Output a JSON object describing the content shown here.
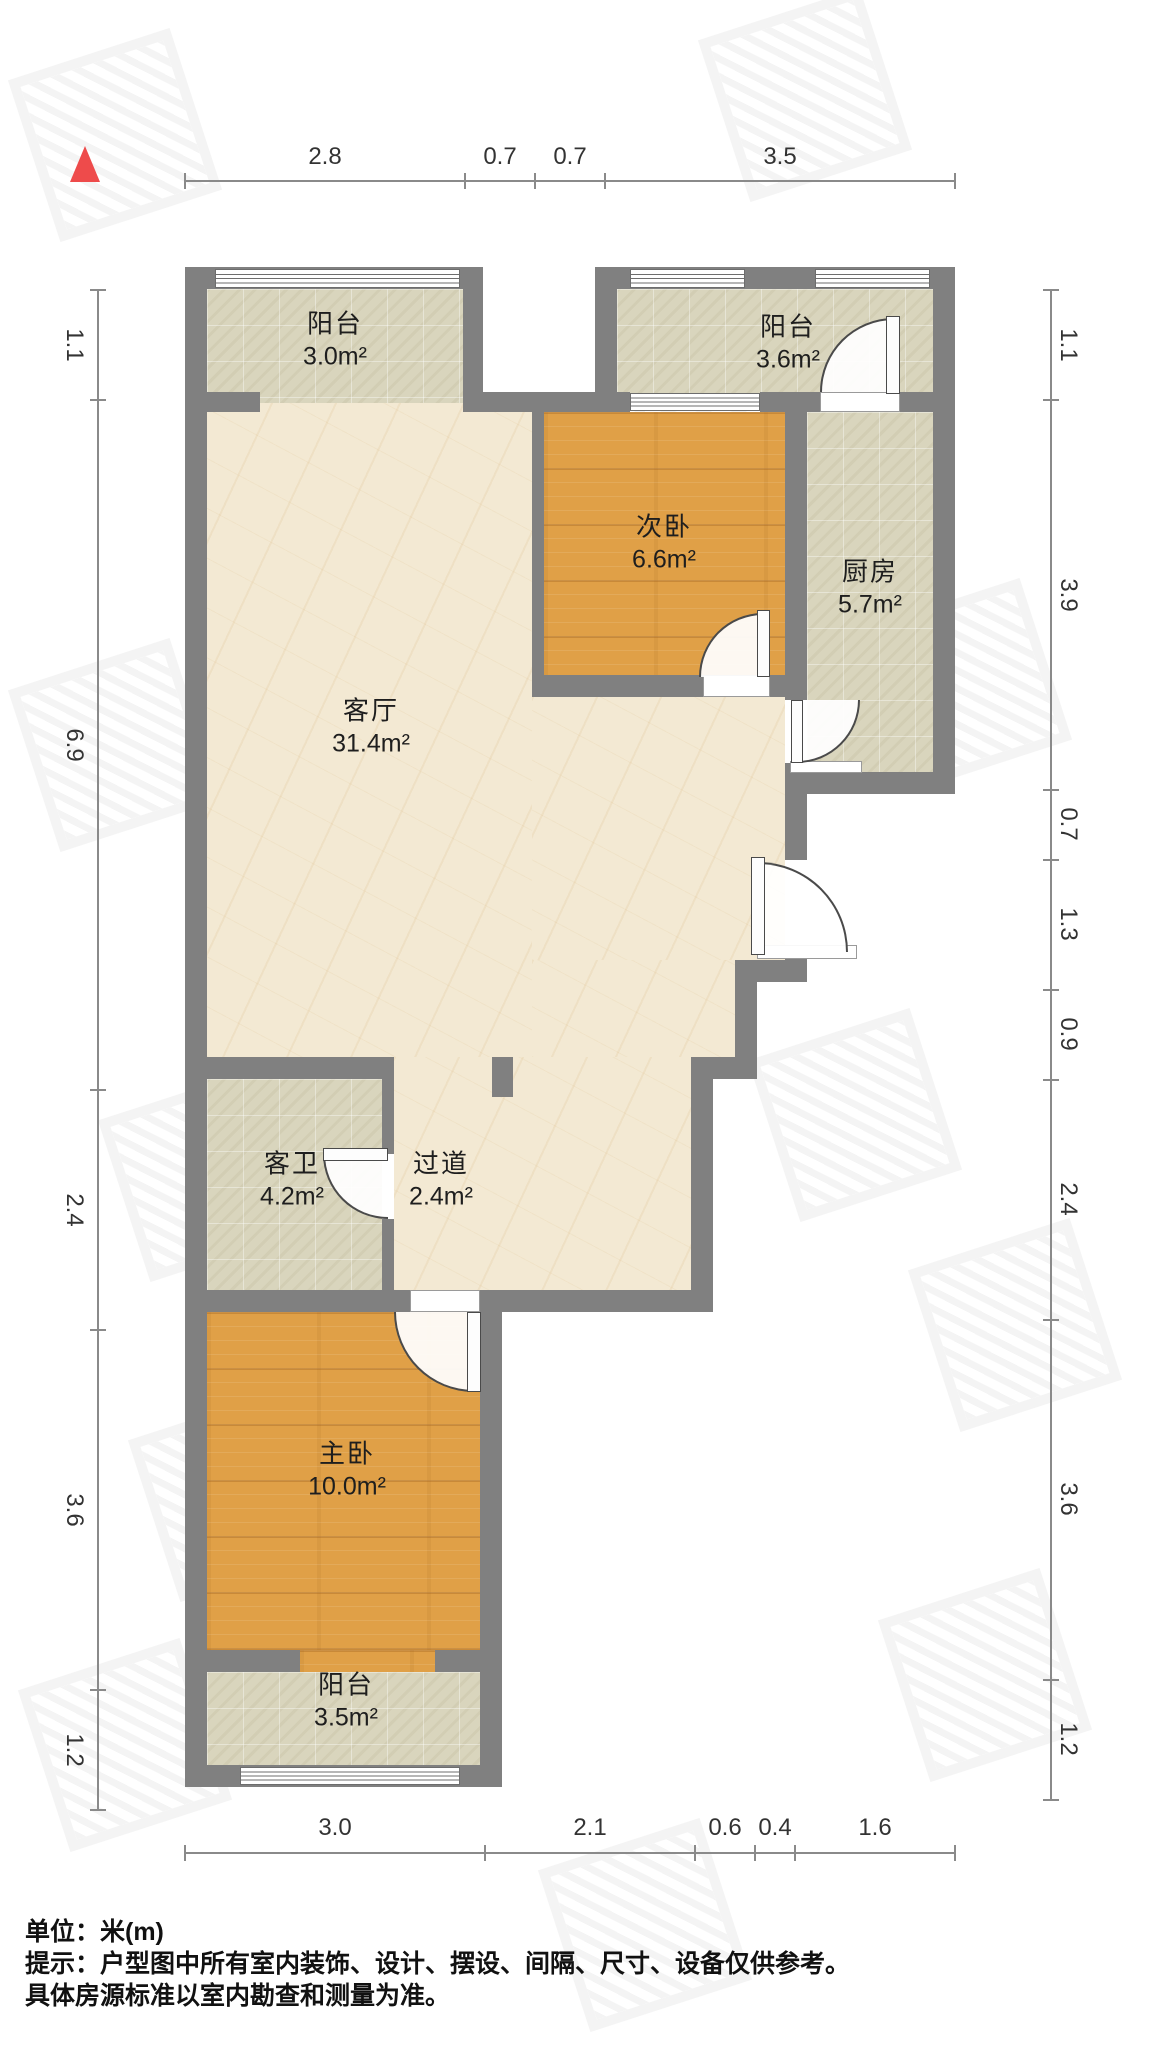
{
  "plan": {
    "type": "apartment-floorplan",
    "north_marker": "north-triangle",
    "colors": {
      "wall": "#808080",
      "wood_floor": "#e0a047",
      "tile_floor": "#d9d5bd",
      "marble_floor": "#f3e9d3",
      "north_red": "#ee4b4b",
      "dimension_line": "#8a8a8a",
      "text": "#1e1e1e"
    }
  },
  "rooms": [
    {
      "name": "阳台",
      "area": "3.0m²"
    },
    {
      "name": "阳台",
      "area": "3.6m²"
    },
    {
      "name": "次卧",
      "area": "6.6m²"
    },
    {
      "name": "厨房",
      "area": "5.7m²"
    },
    {
      "name": "客厅",
      "area": "31.4m²"
    },
    {
      "name": "客卫",
      "area": "4.2m²"
    },
    {
      "name": "过道",
      "area": "2.4m²"
    },
    {
      "name": "主卧",
      "area": "10.0m²"
    },
    {
      "name": "阳台",
      "area": "3.5m²"
    }
  ],
  "dimensions": {
    "top": [
      "2.8",
      "0.7",
      "0.7",
      "3.5"
    ],
    "left": [
      "1.1",
      "6.9",
      "2.4",
      "3.6",
      "1.2"
    ],
    "right": [
      "1.1",
      "3.9",
      "0.7",
      "1.3",
      "0.9",
      "2.4",
      "3.6",
      "1.2"
    ],
    "bottom": [
      "3.0",
      "2.1",
      "0.6",
      "0.4",
      "1.6"
    ]
  },
  "notes": {
    "unit": "单位：米(m)",
    "tip1": "提示：户型图中所有室内装饰、设计、摆设、间隔、尺寸、设备仅供参考。",
    "tip2": "具体房源标准以室内勘查和测量为准。"
  }
}
